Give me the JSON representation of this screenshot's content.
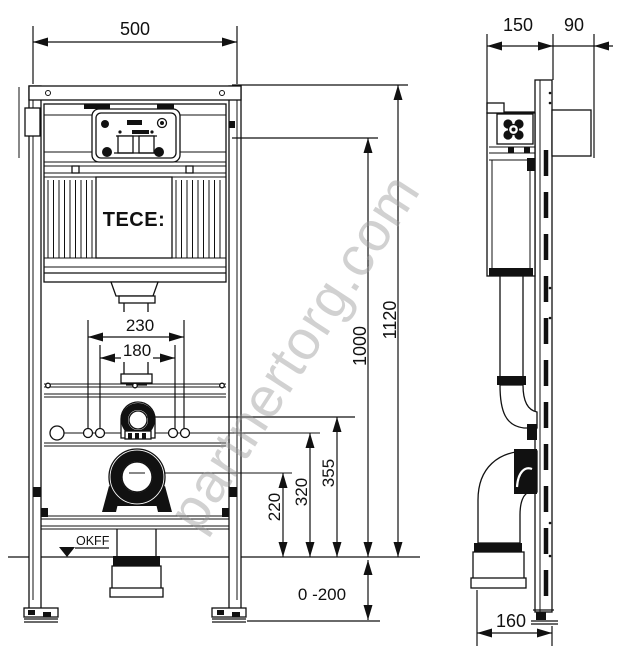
{
  "watermark_text": "partnertorg.com",
  "brand": "TECE:",
  "front": {
    "width": "500",
    "pipe_outer": "230",
    "pipe_inner": "180",
    "height_total": "1120",
    "height_actuator": "1000",
    "height_supply": "355",
    "height_fixing": "320",
    "height_outlet": "220",
    "floor_range": "0 -200",
    "floor_label": "OKFF"
  },
  "side": {
    "depth_frame": "150",
    "depth_bracket": "90",
    "outlet_offset": "160"
  }
}
